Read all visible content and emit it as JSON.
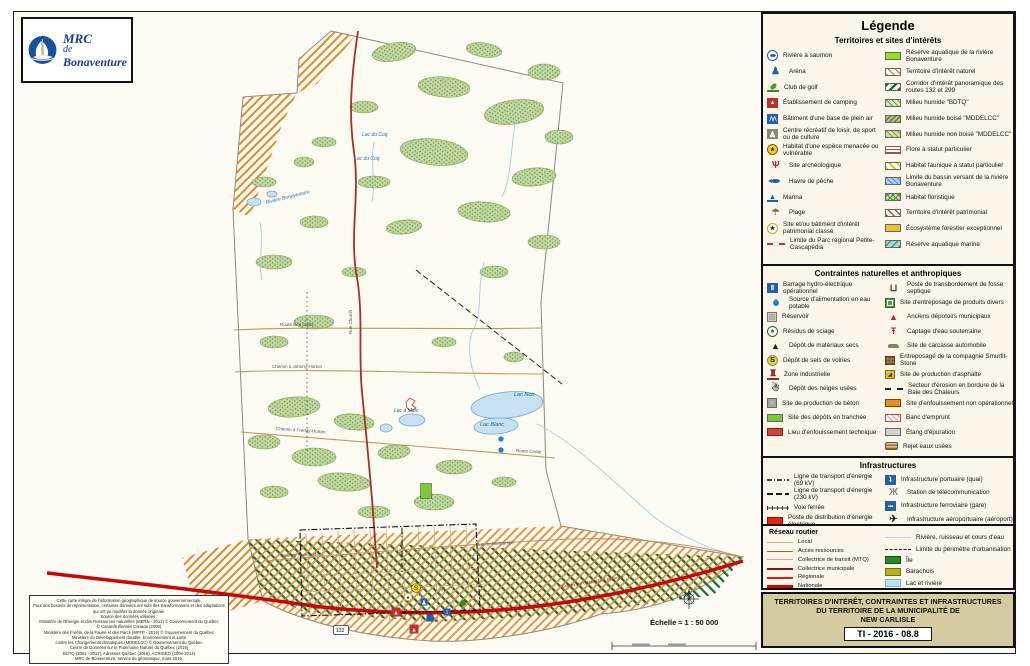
{
  "logo": {
    "line1": "MRC",
    "line2": "de",
    "line3": "Bonaventure"
  },
  "colors": {
    "legend_bg": "#FCF7EA",
    "title_block_bg": "#D5CBA3",
    "route_nationale": "#C80808",
    "water": "#C6E2F2",
    "logo_blue": "#1A3C8C",
    "hatch_orange": "#E08828",
    "hatch_green": "#1A6A2A"
  },
  "legend": {
    "title": "Légende",
    "sections": [
      {
        "title": "Territoires et sites d'intérêts",
        "left": [
          {
            "label": "Rivière à saumon",
            "swatch": "salmon"
          },
          {
            "label": "Aréna",
            "swatch": "arena"
          },
          {
            "label": "Club de golf",
            "swatch": "golf"
          },
          {
            "label": "Établissement de camping",
            "swatch": "camping"
          },
          {
            "label": "Bâtiment d'une base de plein air",
            "swatch": "pleinair"
          },
          {
            "label": "Centre récréatif de loisir, de sport ou de culture",
            "swatch": "recreation"
          },
          {
            "label": "Habitat d'une espèce menacée ou vulnérable",
            "swatch": "turtle"
          },
          {
            "label": "Site archéologique",
            "swatch": "archeo"
          },
          {
            "label": "Havre de pêche",
            "swatch": "fishharbor"
          },
          {
            "label": "Marina",
            "swatch": "marina"
          },
          {
            "label": "Plage",
            "swatch": "beach"
          },
          {
            "label": "Site et/ou bâtiment d'intérêt patrimonial classé",
            "swatch": "heritage"
          },
          {
            "label": "Limite du Parc régional Petite-Cascapédia",
            "swatch": "parklimit"
          }
        ],
        "right": [
          {
            "label": "Réserve aquatique de la rivière Bonaventure",
            "swatch": "resaq"
          },
          {
            "label": "Territoire d'intérêt naturel",
            "swatch": "tnat"
          },
          {
            "label": "Corridor d'intérêt panoramique des routes 132 et 299",
            "swatch": "corridor"
          },
          {
            "label": "Milieu humide \"BDTQ\"",
            "swatch": "mhbdtq"
          },
          {
            "label": "Milieu humide boisé \"MDDELCC\"",
            "swatch": "mhboise"
          },
          {
            "label": "Milieu humide non boisé \"MDDELCC\"",
            "swatch": "mhnonboise"
          },
          {
            "label": "Flore à statut particulier",
            "swatch": "flore"
          },
          {
            "label": "Habitat faunique à statut particulier",
            "swatch": "habfaun"
          },
          {
            "label": "Limite du bassin versant de la rivière Bonaventure",
            "swatch": "bassin"
          },
          {
            "label": "Habitat floristique",
            "swatch": "habflor"
          },
          {
            "label": "Territoire d'intérêt patrimonial",
            "swatch": "tpat"
          },
          {
            "label": "Écosystème forestier exceptionnel",
            "swatch": "ecosys"
          },
          {
            "label": "Réserve aquatique marine",
            "swatch": "resmar"
          }
        ]
      },
      {
        "title": "Contraintes naturelles et anthropiques",
        "left": [
          {
            "label": "Barrage hydro-électrique opérationnel",
            "swatch": "barrage"
          },
          {
            "label": "Source d'alimentation en eau potable",
            "swatch": "drop"
          },
          {
            "label": "Réservoir",
            "swatch": "reservoir"
          },
          {
            "label": "Résidus de sciage",
            "swatch": "sciage"
          },
          {
            "label": "Dépôt de matériaux secs",
            "swatch": "matsecs"
          },
          {
            "label": "Dépôt de sels de voiries",
            "swatch": "sels"
          },
          {
            "label": "Zone industrielle",
            "swatch": "zoneind"
          },
          {
            "label": "Dépôt des neiges usées",
            "swatch": "neiges"
          },
          {
            "label": "Site de production de béton",
            "swatch": "beton"
          },
          {
            "label": "Site des dépôts en tranchée",
            "swatch": "tranchee"
          },
          {
            "label": "Lieu d'enfouissement technique",
            "swatch": "enftech"
          }
        ],
        "right": [
          {
            "label": "Poste de transbordement de fosse septique",
            "swatch": "fosse"
          },
          {
            "label": "Site d'entreposage de produits divers",
            "swatch": "produits"
          },
          {
            "label": "Anciens dépotoirs municipaux",
            "swatch": "depotoirs"
          },
          {
            "label": "Captage d'eau souterraine",
            "swatch": "captage"
          },
          {
            "label": "Site de carcasse automobile",
            "swatch": "carcasse"
          },
          {
            "label": "Entreposage de la compagnie Smurfit-Stone",
            "swatch": "smurfit"
          },
          {
            "label": "Site de production d'asphalte",
            "swatch": "asphalte"
          },
          {
            "label": "Secteur d'érosion en bordure de la Baie des Chaleurs",
            "swatch": "erosion"
          },
          {
            "label": "Site d'enfouissement non opérationnel",
            "swatch": "enfnonop"
          },
          {
            "label": "Banc d'emprunt",
            "swatch": "banc"
          },
          {
            "label": "Étang d'épuration",
            "swatch": "etang"
          },
          {
            "label": "Rejet eaux usées",
            "swatch": "rejet"
          }
        ]
      },
      {
        "title": "Infrastructures",
        "left": [
          {
            "label": "Ligne de transport d'énergie (69 kV)",
            "swatch": "l69"
          },
          {
            "label": "Ligne de transport d'énergie (230 kV)",
            "swatch": "l230"
          },
          {
            "label": "Voie ferrée",
            "swatch": "rail"
          },
          {
            "label": "Poste de distribution d'énergie électrique",
            "swatch": "postedist"
          }
        ],
        "right": [
          {
            "label": "Infrastructure portuaire (quai)",
            "swatch": "portuaire"
          },
          {
            "label": "Station de télécommunication",
            "swatch": "telecom"
          },
          {
            "label": "Infrastructure ferroviaire (gare)",
            "swatch": "gare"
          },
          {
            "label": "Infrastructure aéroportuaire (aéroport)",
            "swatch": "aeroport"
          }
        ]
      },
      {
        "title": "Réseau routier",
        "left": [
          {
            "label": "Local",
            "swatch": "local"
          },
          {
            "label": "Accès ressources",
            "swatch": "acces"
          },
          {
            "label": "Collectrice de transit (MTQ)",
            "swatch": "colltransit"
          },
          {
            "label": "Collectrice municipale",
            "swatch": "collmun"
          },
          {
            "label": "Régionale",
            "swatch": "regionale"
          },
          {
            "label": "Nationale",
            "swatch": "nationale"
          }
        ],
        "right": [
          {
            "label": "Rivière, ruisseau et cours d'eau",
            "swatch": "riviereline"
          },
          {
            "label": "Limite du périmètre d'urbanisation",
            "swatch": "perimetre"
          },
          {
            "label": "Île",
            "swatch": "ile"
          },
          {
            "label": "Barachois",
            "swatch": "barachois"
          },
          {
            "label": "Lac et rivière",
            "swatch": "lacriviere"
          }
        ]
      }
    ]
  },
  "title_block": {
    "line1": "TERRITOIRES D'INTÉRÊT, CONTRAINTES ET INFRASTRUCTURES",
    "line2": "DU TERRITOIRE DE LA MUNICIPALITÉ DE",
    "line3": "NEW CARLISLE",
    "code": "TI - 2016 - 08.8"
  },
  "map": {
    "scale_label": "Échelle ≈ 1 : 50 000",
    "labels": [
      {
        "t": "Rivière Bonaventure",
        "x": 252,
        "y": 192,
        "c": "#3070B8",
        "s": 5,
        "i": true,
        "r": -14
      },
      {
        "t": "Lac du Coq",
        "x": 348,
        "y": 124,
        "c": "#3070B8",
        "s": 5,
        "i": true
      },
      {
        "t": "Lac du Coq",
        "x": 340,
        "y": 148,
        "c": "#3070B8",
        "s": 5,
        "i": true
      },
      {
        "t": "Lac Noir",
        "x": 500,
        "y": 384,
        "c": "#2A5A8A",
        "s": 5.5,
        "i": true
      },
      {
        "t": "Lac Blanc",
        "x": 466,
        "y": 414,
        "c": "#2A5A8A",
        "s": 5.5,
        "i": true
      },
      {
        "t": "Lac à Marc",
        "x": 380,
        "y": 400,
        "c": "#2A5A8A",
        "s": 5,
        "i": true
      },
      {
        "t": "Route Ben Gallis",
        "x": 266,
        "y": 314,
        "c": "#555",
        "s": 4.5
      },
      {
        "t": "Chemin à Johnny-Horton",
        "x": 258,
        "y": 356,
        "c": "#555",
        "s": 4.5
      },
      {
        "t": "Chemin à Freddy-Horton",
        "x": 262,
        "y": 418,
        "c": "#555",
        "s": 4.5,
        "r": 4
      },
      {
        "t": "Route Cedar",
        "x": 502,
        "y": 440,
        "c": "#555",
        "s": 4.5,
        "r": 3
      },
      {
        "t": "Rue Church",
        "x": 338,
        "y": 322,
        "c": "#555",
        "s": 4.5,
        "r": -90
      },
      {
        "t": "Rue de Normandie",
        "x": 268,
        "y": 545,
        "c": "#555",
        "s": 4.5,
        "r": -2
      },
      {
        "t": "Rue de Normandie",
        "x": 462,
        "y": 534,
        "c": "#555",
        "s": 4.5,
        "r": -3
      },
      {
        "t": "Boulevard Gérard-D.-Lévesque",
        "x": 548,
        "y": 576,
        "c": "#8A2020",
        "s": 4.5,
        "r": -9
      },
      {
        "t": "132",
        "x": 322,
        "y": 620,
        "c": "#111",
        "s": 5,
        "shield": true
      }
    ],
    "markers": [
      {
        "type": "camping",
        "x": 382,
        "y": 600
      },
      {
        "type": "camping",
        "x": 400,
        "y": 617
      },
      {
        "type": "salt",
        "x": 402,
        "y": 576
      },
      {
        "type": "marina",
        "x": 416,
        "y": 606
      },
      {
        "type": "port",
        "x": 433,
        "y": 600
      },
      {
        "type": "arena",
        "x": 410,
        "y": 590
      },
      {
        "type": "heritage",
        "x": 394,
        "y": 585
      },
      {
        "type": "golf",
        "x": 449,
        "y": 591
      },
      {
        "type": "drop",
        "x": 487,
        "y": 427
      },
      {
        "type": "drop",
        "x": 487,
        "y": 438
      },
      {
        "type": "telecom",
        "x": 428,
        "y": 580
      },
      {
        "type": "trench",
        "x": 412,
        "y": 479
      }
    ],
    "credits": [
      "Cette carte intègre de l'information géographique de source gouvernementale.",
      "Pour des besoins de représentation, certaines données ont subi des transformations et des adaptations",
      "qui ont pu modifier la donnée originale.",
      "Source des données utilisées :",
      "Ministère de l'Énergie et des Ressources naturelles (MERN - 2012) © Gouvernement du Québec",
      "© Canards Illimités Canada (2009)",
      "Ministère des Forêts, de la Faune et des Parcs (MFFP - 2016) © Gouvernement du Québec",
      "Ministère du Développement durable, Environnement et Lutte",
      "contre les Changements climatiques (MDDELCC) © Gouvernement du Québec",
      "Centre de Données sur le Patrimoine Naturel du Québec (2016)",
      "BDTQ (2001 - 2012), Adresses Québec (2016), ACRIGÉO (2004-2014)",
      "MRC de Bonaventure, service de géomatique, mars 2016."
    ]
  }
}
